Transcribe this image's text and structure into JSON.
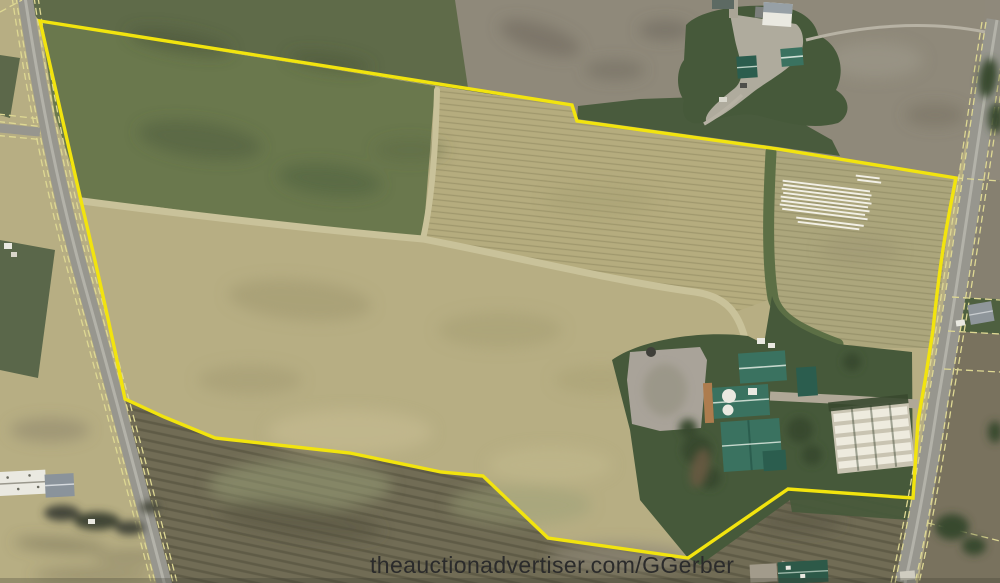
{
  "watermark": {
    "text": "theauctionadvertiser.com/GGerber"
  },
  "scene": {
    "type": "aerial-photo-auction-parcel",
    "boundary_color": "#f2e40e",
    "colors": {
      "base-tan": "#b7ae83",
      "field-olive": "#5f6b49",
      "field-green": "#6a784d",
      "field-rows": "#b5ac7e",
      "field-gray": "#8f897a",
      "plow-dark": "#716c55",
      "waterway": "#c9c29a",
      "lawn": "#46593a",
      "tree": "#39482f",
      "road": "#97968e",
      "road-edge": "#ded893",
      "boundary": "#f2e40e",
      "gravel": "#a9a399",
      "roof-teal": "#3a7260",
      "roof-teal-dark": "#2b5d4e",
      "building-white": "#eae9e1",
      "roof-gray": "#97a0a6",
      "feedlot-bg": "#c9c4b2",
      "feedlot-white": "#eeebde",
      "rust": "#ad7c4e",
      "watermark": "#2b2b2b"
    }
  }
}
